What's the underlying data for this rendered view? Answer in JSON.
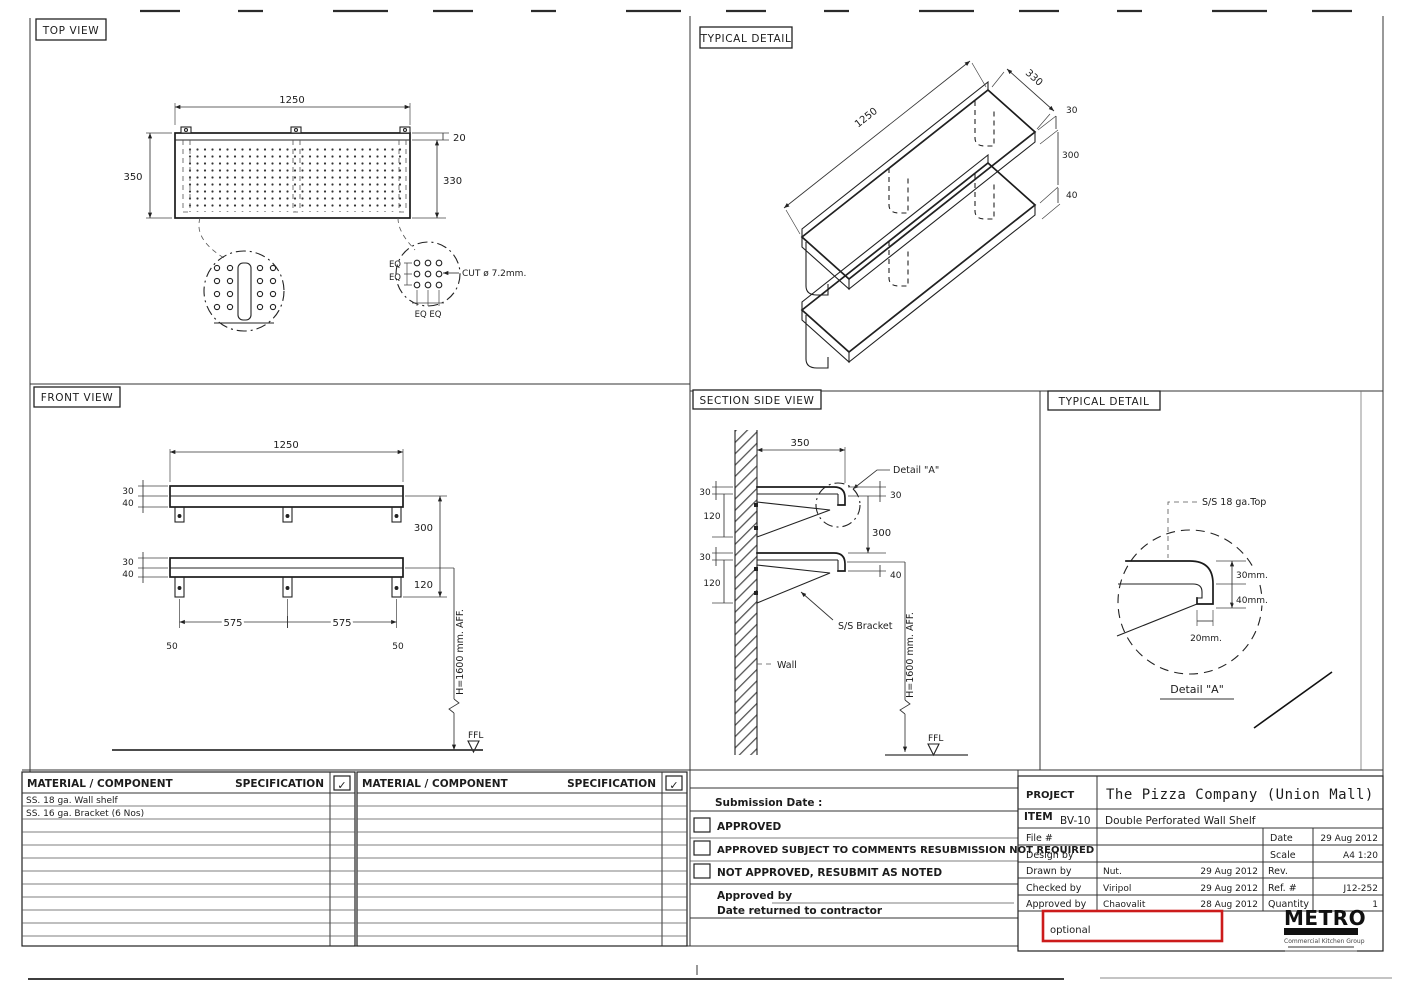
{
  "top_view": {
    "title": "TOP VIEW",
    "dim_width": "1250",
    "dim_depth": "350",
    "dim_lip": "20",
    "dim_inner": "330",
    "eq_a": "EQ",
    "eq_b": "EQ",
    "eq_bottom": "EQ EQ",
    "cut_note": "CUT ø 7.2mm."
  },
  "iso_view": {
    "title": "TYPICAL DETAIL",
    "dim_depth": "330",
    "dim_width": "1250",
    "dim_top": "30",
    "dim_gap": "300",
    "dim_lip": "40"
  },
  "front_view": {
    "title": "FRONT VIEW",
    "dim_width": "1250",
    "u30": "30",
    "u40": "40",
    "l30": "30",
    "l40": "40",
    "gap": "300",
    "d120": "120",
    "span_a": "575",
    "span_b": "575",
    "off_a": "50",
    "off_b": "50",
    "height_note": "H=1600 mm. AFF.",
    "ffl": "FFL"
  },
  "section_view": {
    "title": "SECTION SIDE VIEW",
    "dim_depth": "350",
    "detail_ref": "Detail \"A\"",
    "u30": "30",
    "u120": "120",
    "r30": "30",
    "gap": "300",
    "l30": "30",
    "l120": "120",
    "r40": "40",
    "bracket_label": "S/S Bracket",
    "wall_label": "Wall",
    "height_note": "H=1600 mm. AFF.",
    "ffl": "FFL"
  },
  "detail_a": {
    "title": "TYPICAL DETAIL",
    "material_note": "S/S 18 ga.Top",
    "d30": "30mm.",
    "d40": "40mm.",
    "d20": "20mm.",
    "caption": "Detail \"A\""
  },
  "materials_left": {
    "col_component": "MATERIAL / COMPONENT",
    "col_spec": "SPECIFICATION",
    "check": "✓",
    "row_1": "SS. 18 ga. Wall shelf",
    "row_2": "SS. 16 ga. Bracket (6 Nos)"
  },
  "materials_right": {
    "col_component": "MATERIAL / COMPONENT",
    "col_spec": "SPECIFICATION",
    "check": "✓"
  },
  "submission": {
    "date_label": "Submission Date :",
    "opt_approved": "APPROVED",
    "opt_subject": "APPROVED SUBJECT TO COMMENTS RESUBMISSION NOT REQUIRED",
    "opt_not": "NOT APPROVED, RESUBMIT AS NOTED",
    "approved_by": "Approved by",
    "returned": "Date returned to contractor"
  },
  "title_block": {
    "project_label": "PROJECT",
    "project_name": "The Pizza Company (Union Mall)",
    "item_label": "ITEM",
    "item_code": "BV-10",
    "item_name": "Double Perforated Wall Shelf",
    "file_label": "File #",
    "design_label": "Design by",
    "drawn_label": "Drawn by",
    "drawn_name": "Nut.",
    "drawn_date": "29 Aug 2012",
    "checked_label": "Checked by",
    "checked_name": "Viripol",
    "checked_date": "29 Aug 2012",
    "approved_label": "Approved by",
    "approved_name": "Chaovalit",
    "approved_date": "28 Aug 2012",
    "date_label": "Date",
    "date_value": "29 Aug 2012",
    "scale_label": "Scale",
    "scale_value": "A4 1:20",
    "rev_label": "Rev.",
    "ref_label": "Ref. #",
    "ref_value": "J12-252",
    "qty_label": "Quantity",
    "qty_value": "1"
  },
  "annotation": {
    "text": "optional",
    "color": "#cc1b1b"
  },
  "logo": {
    "name": "METRO",
    "tagline": "Commercial Kitchen Group"
  }
}
